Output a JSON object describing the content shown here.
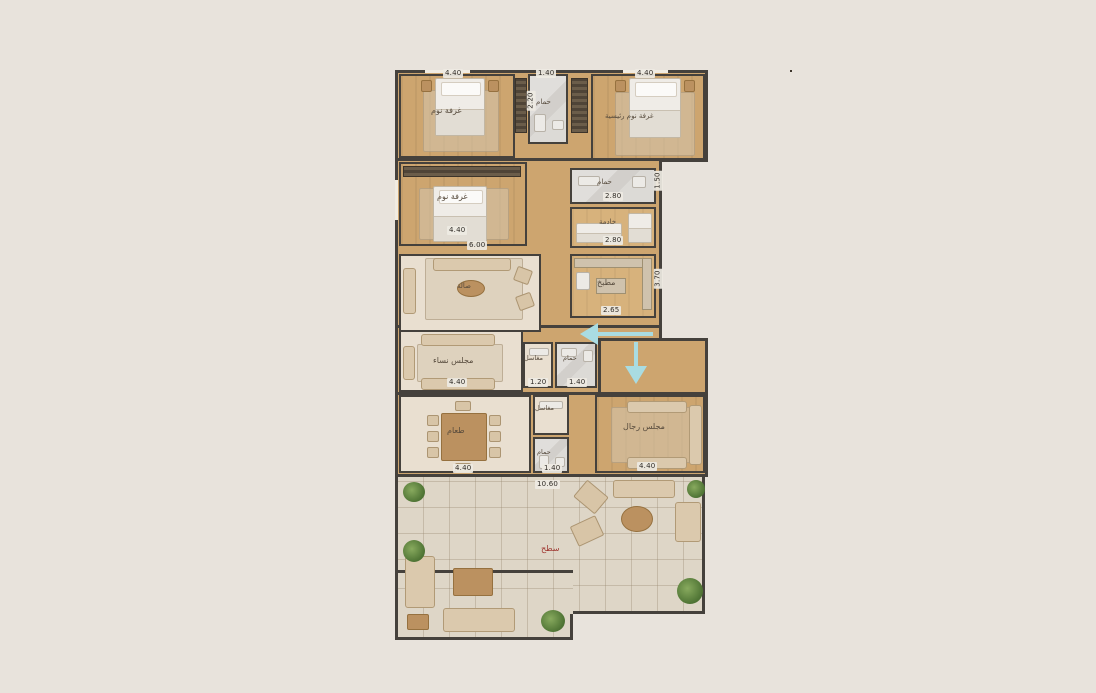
{
  "colors": {
    "bg": "#e8e3dc",
    "wall": "#45413c",
    "wood": "#cda56f",
    "cream": "#e9dfd0",
    "marble": "#d9d6d2",
    "tile": "#ded6c7",
    "arrow": "#a9dce2",
    "terrace-label": "#9e332d",
    "dim-text": "#2f2b26"
  },
  "rooms": {
    "bedroom1": {
      "label": "غرفة نوم",
      "dim_top": "4.40"
    },
    "bath_top": {
      "label": "حمام",
      "dim_top": "1.40",
      "dim_side": "2.20"
    },
    "master": {
      "label": "غرفة نوم رئيسية",
      "dim_top": "4.40"
    },
    "bedroom2": {
      "label": "غرفة نوم",
      "dim": "4.40",
      "dim_bottom": "6.00"
    },
    "bath2": {
      "label": "حمام",
      "dim": "2.80",
      "dim_side": "1.50"
    },
    "maid": {
      "label": "خادمة",
      "dim": "2.80"
    },
    "hall": {
      "label": "صالة"
    },
    "kitchen": {
      "label": "مطبخ",
      "dim": "2.65",
      "dim_side": "3.70"
    },
    "women_majlis": {
      "label": "مجلس نساء",
      "dim": "4.40"
    },
    "wash1": {
      "label": "مغاسل",
      "dim": "1.20"
    },
    "bath_mid": {
      "label": "حمام",
      "dim": "1.40"
    },
    "dining": {
      "label": "طعام",
      "dim": "4.40"
    },
    "wash2": {
      "label": "مغاسل"
    },
    "bath_low": {
      "label": "حمام",
      "dim": "1.40"
    },
    "men_majlis": {
      "label": "مجلس رجال",
      "dim": "4.40"
    },
    "terrace": {
      "label": "سطح",
      "dim": "10.60"
    }
  }
}
